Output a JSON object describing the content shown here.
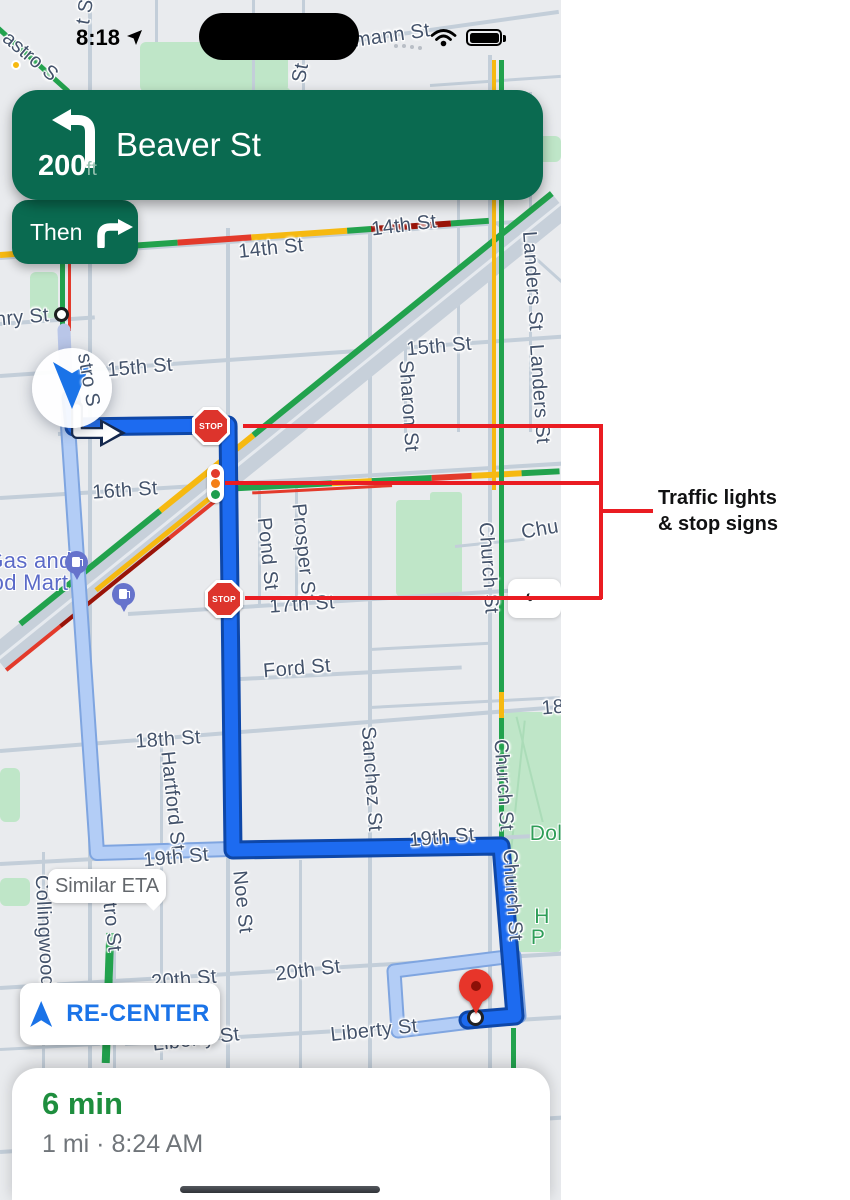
{
  "colors": {
    "map_bg": "#e9ebee",
    "road": "#c3ced9",
    "band": "#c7d0da",
    "park": "#bfe6c8",
    "park_dark": "#abdcb8",
    "banner_green": "#0a6a50",
    "banner_subtle": "#93bfae",
    "route_blue": "#1d6bf0",
    "route_casing": "#0e47a8",
    "alt_route": "#b3cdf6",
    "alt_casing": "#7fa5e0",
    "traveled": "#b9c6e8",
    "traffic_green": "#22a24d",
    "traffic_yellow": "#f6b911",
    "traffic_orange": "#f57f17",
    "traffic_red": "#e33a2b",
    "traffic_dark_red": "#991409",
    "street_label": "#44536b",
    "poi_label": "#5b6ac8",
    "park_label": "#2f9e58",
    "stop_sign_red": "#dd342c",
    "annotation_red": "#ea1c22",
    "annotation_text": "#101112",
    "recenter_blue": "#1a73e8",
    "eta_green": "#1e8e3e",
    "gray_text": "#70757a",
    "bubble_text": "#64686d",
    "pin_red": "#e7352a",
    "gas_pin": "#6673cc"
  },
  "status_bar": {
    "time": "8:18"
  },
  "navigation": {
    "distance": "200",
    "distance_unit": "ft",
    "street": "Beaver St",
    "then_label": "Then"
  },
  "map": {
    "stop_sign_label": "STOP",
    "similar_eta_label": "Similar ETA",
    "recenter_label": "RE-CENTER",
    "back_chevron": "‹",
    "labels": [
      {
        "text": "astro S",
        "x": 30,
        "y": 57,
        "rot": 40
      },
      {
        "text": "t St",
        "x": 86,
        "y": 9,
        "rot": -80
      },
      {
        "text": "St",
        "x": 301,
        "y": 73,
        "rot": -80
      },
      {
        "text": "mann St",
        "x": 392,
        "y": 36,
        "rot": -8
      },
      {
        "text": "14th St",
        "x": 271,
        "y": 249,
        "rot": -6
      },
      {
        "text": "14th St",
        "x": 404,
        "y": 226,
        "rot": -7
      },
      {
        "text": "Landers St",
        "x": 532,
        "y": 281,
        "rot": 86
      },
      {
        "text": "Landers St",
        "x": 539,
        "y": 394,
        "rot": 86
      },
      {
        "text": "15th St",
        "x": 140,
        "y": 368,
        "rot": -5
      },
      {
        "text": "15th St",
        "x": 439,
        "y": 347,
        "rot": -5
      },
      {
        "text": "Sharon St",
        "x": 408,
        "y": 406,
        "rot": 86
      },
      {
        "text": "nry St",
        "x": 22,
        "y": 318,
        "rot": -5
      },
      {
        "text": "stro S",
        "x": 88,
        "y": 380,
        "rot": 80
      },
      {
        "text": "16th St",
        "x": 125,
        "y": 491,
        "rot": -4
      },
      {
        "text": "Pond St",
        "x": 267,
        "y": 554,
        "rot": 84
      },
      {
        "text": "Prosper St",
        "x": 303,
        "y": 552,
        "rot": 84
      },
      {
        "text": "Church St",
        "x": 488,
        "y": 568,
        "rot": 86
      },
      {
        "text": "Chu",
        "x": 540,
        "y": 530,
        "rot": -10
      },
      {
        "text": "17th St",
        "x": 302,
        "y": 605,
        "rot": -4
      },
      {
        "text": "Gas and",
        "x": 29,
        "y": 561,
        "cls": "poi",
        "fs": 22
      },
      {
        "text": "od Mart",
        "x": 30,
        "y": 583,
        "cls": "poi",
        "fs": 22
      },
      {
        "text": "Ford St",
        "x": 297,
        "y": 669,
        "rot": -5
      },
      {
        "text": "18th St",
        "x": 168,
        "y": 740,
        "rot": -4
      },
      {
        "text": "Hartford St",
        "x": 172,
        "y": 801,
        "rot": 84
      },
      {
        "text": "Sanchez St",
        "x": 371,
        "y": 779,
        "rot": 86
      },
      {
        "text": "18",
        "x": 553,
        "y": 708,
        "rot": -5
      },
      {
        "text": "19th St",
        "x": 176,
        "y": 858,
        "rot": -5
      },
      {
        "text": "19th St",
        "x": 442,
        "y": 838,
        "rot": -5
      },
      {
        "text": "Noe St",
        "x": 242,
        "y": 902,
        "rot": 84
      },
      {
        "text": "Collingwood",
        "x": 44,
        "y": 931,
        "rot": 87
      },
      {
        "text": "stro St",
        "x": 111,
        "y": 922,
        "rot": 84
      },
      {
        "text": "Church St",
        "x": 503,
        "y": 785,
        "rot": 86
      },
      {
        "text": "Church St",
        "x": 512,
        "y": 895,
        "rot": 86
      },
      {
        "text": "Dol",
        "x": 546,
        "y": 834,
        "cls": "park",
        "fs": 21
      },
      {
        "text": "H",
        "x": 542,
        "y": 917,
        "cls": "park",
        "fs": 21
      },
      {
        "text": "P",
        "x": 538,
        "y": 938,
        "cls": "park",
        "fs": 21
      },
      {
        "text": "20th St",
        "x": 184,
        "y": 980,
        "rot": -5
      },
      {
        "text": "20th St",
        "x": 308,
        "y": 971,
        "rot": -7
      },
      {
        "text": "Liberty St",
        "x": 374,
        "y": 1031,
        "rot": -6
      },
      {
        "text": "Liberty St",
        "x": 196,
        "y": 1040,
        "rot": -7
      }
    ]
  },
  "annotation": {
    "line1": "Traffic lights",
    "line2": "& stop signs"
  },
  "trip": {
    "eta": "6 min",
    "details": "1 mi · 8:24 AM"
  }
}
